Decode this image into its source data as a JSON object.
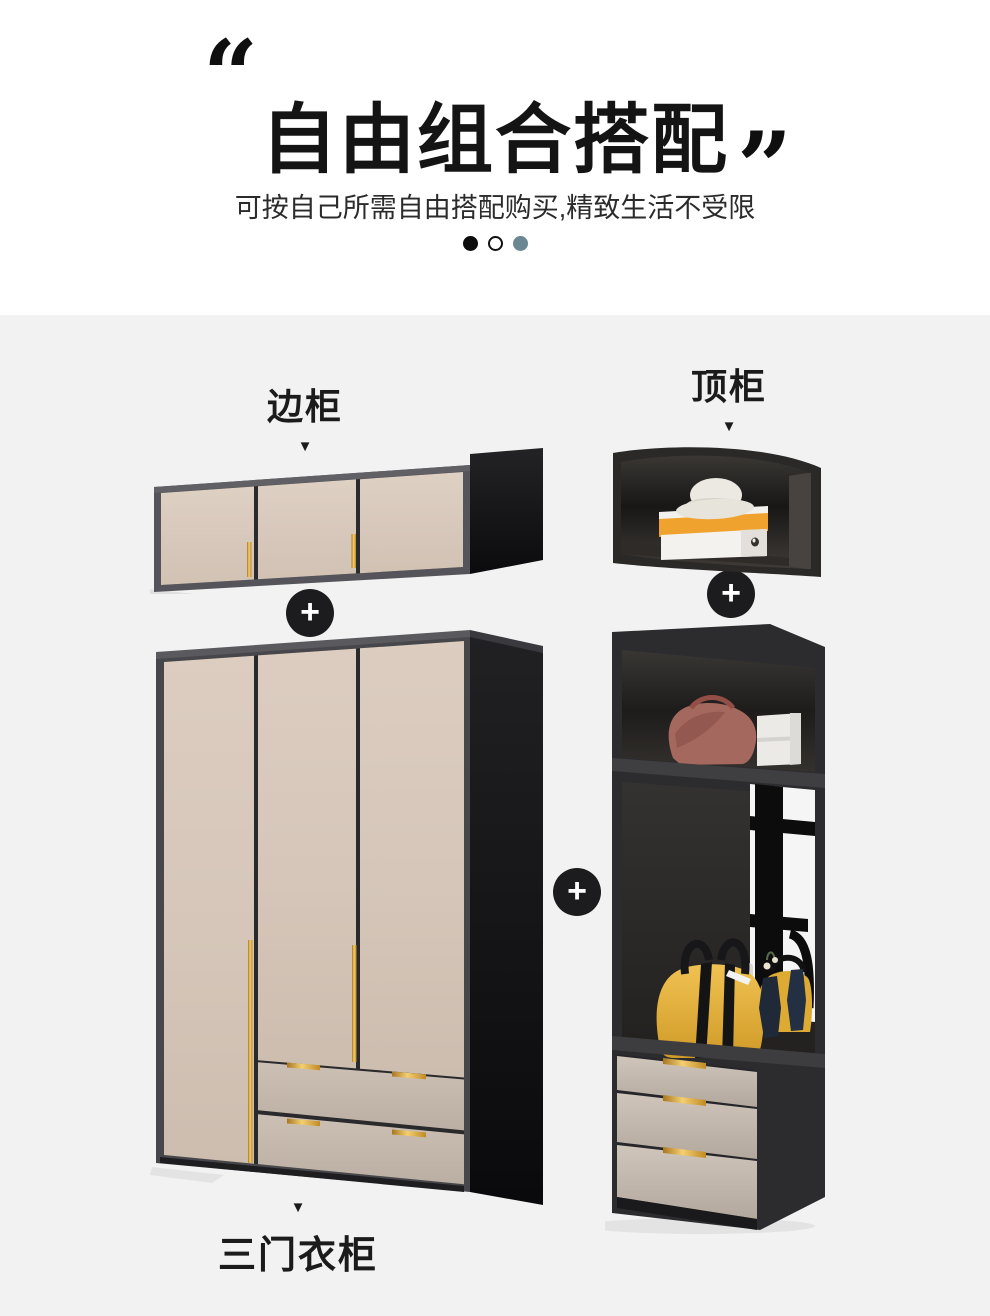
{
  "header": {
    "quote_open": "“",
    "quote_close": "”",
    "title": "自由组合搭配",
    "subtitle": "可按自己所需自由搭配购买,精致生活不受限"
  },
  "carousel": {
    "dots": [
      {
        "name": "dot-1",
        "style": "black"
      },
      {
        "name": "dot-2",
        "style": "outline"
      },
      {
        "name": "dot-3",
        "style": "teal"
      }
    ]
  },
  "items": {
    "side_cabinet": {
      "label": "边柜",
      "pointer": "▼"
    },
    "top_cabinet": {
      "label": "顶柜",
      "pointer": "▼"
    },
    "wardrobe": {
      "label": "三门衣柜",
      "pointer": "▼"
    }
  },
  "connector": {
    "plus": "+"
  },
  "colors": {
    "page_top_background": "#ffffff",
    "section_background": "#f2f2f2",
    "heading_text": "#141414",
    "dot_active_black": "#0c0c0c",
    "dot_teal": "#6b8792",
    "cabinet_frame_gray": "#54545a",
    "cabinet_black_side": "#121214",
    "door_panel_beige": "#d7c9bd",
    "drawer_panel_beige": "#c2b6ab",
    "handle_gold": "#e3ab4f",
    "shoebox_orange": "#f0a22e",
    "handbag_yellow": "#e4ae36",
    "handbag_pink": "#a5685e",
    "vase_navy": "#1f2937",
    "plus_badge_black": "#1c1c1e"
  }
}
